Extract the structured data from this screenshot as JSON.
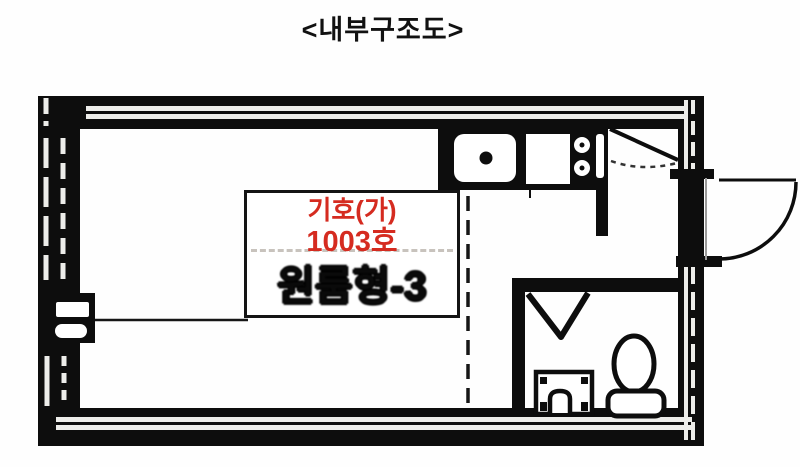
{
  "title": "<내부구조도>",
  "floor_plan": {
    "unit_label": {
      "symbol": "기호(가)",
      "room_number": "1003호",
      "unit_type": "원룸형-3"
    },
    "icons": {
      "kitchen_sink": "sink-with-drain",
      "kitchen_counter": "countertop",
      "stove": "two-burner-stove",
      "entrance_door": "door-swing-diagonal",
      "exterior_door": "door-swing-quarter-arc",
      "bathroom_door": "door-swing-triangle",
      "washbasin": "washstand-front",
      "toilet": "toilet-top-view",
      "ac_unit": "wall-unit-with-vents",
      "windows": "double-glazing-lines",
      "room_divider": "dashed-boundary-line"
    },
    "colors": {
      "label_red": "#d52b20",
      "plan_black": "#0d0d0d",
      "paper_white": "#fefefe",
      "glazing_gray": "#e8e8e8"
    }
  }
}
